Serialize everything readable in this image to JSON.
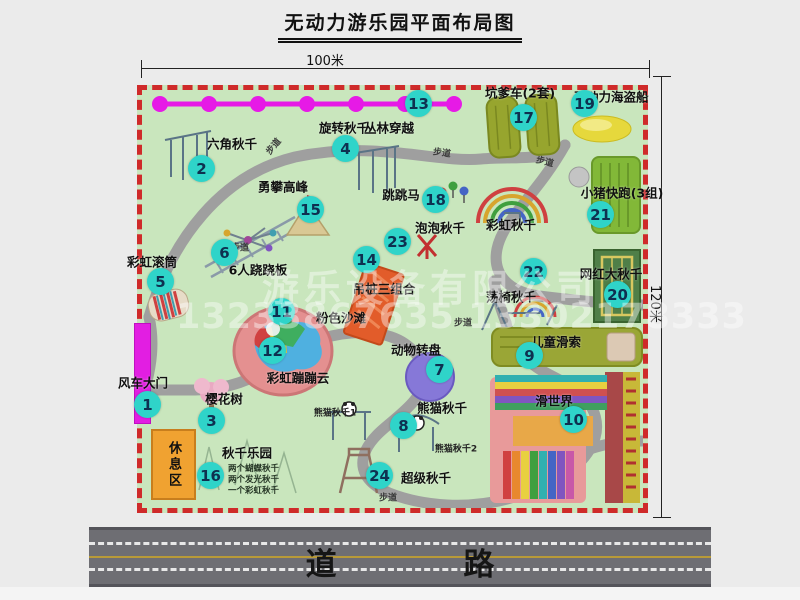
{
  "title": "无动力游乐园平面布局图",
  "dimensions": {
    "top": "100米",
    "right": "120米"
  },
  "road": {
    "label": "道  路"
  },
  "watermark": {
    "company": "游乐设备有限公司",
    "phones": "13233867635 13302178333"
  },
  "map": {
    "path_label": "步道",
    "rest_area": "休息区",
    "rainbow_swing_label": "彩虹秋千",
    "panda_sub1": "熊猫秋千1",
    "panda_sub2": "熊猫秋千2",
    "swing_park_notes": [
      "两个蝴蝶秋千",
      "两个发光秋千",
      "一个彩虹秋千"
    ]
  },
  "attractions": [
    {
      "num": "1",
      "label": "风车大门",
      "bx": 147,
      "by": 404,
      "lx": 143,
      "ly": 382
    },
    {
      "num": "2",
      "label": "六角秋千",
      "bx": 201,
      "by": 168,
      "lx": 232,
      "ly": 143
    },
    {
      "num": "3",
      "label": "樱花树",
      "bx": 211,
      "by": 420,
      "lx": 224,
      "ly": 398
    },
    {
      "num": "4",
      "label": "旋转秋千",
      "bx": 345,
      "by": 148,
      "lx": 344,
      "ly": 127
    },
    {
      "num": "5",
      "label": "彩虹滚筒",
      "bx": 160,
      "by": 281,
      "lx": 152,
      "ly": 261
    },
    {
      "num": "6",
      "label": "6人跷跷板",
      "bx": 224,
      "by": 252,
      "lx": 258,
      "ly": 269
    },
    {
      "num": "7",
      "label": "动物转盘",
      "bx": 439,
      "by": 369,
      "lx": 416,
      "ly": 349
    },
    {
      "num": "8",
      "label": "熊猫秋千",
      "bx": 403,
      "by": 425,
      "lx": 442,
      "ly": 407
    },
    {
      "num": "9",
      "label": "儿童滑索",
      "bx": 529,
      "by": 355,
      "lx": 556,
      "ly": 341
    },
    {
      "num": "10",
      "label": "滑世界",
      "bx": 573,
      "by": 419,
      "lx": 554,
      "ly": 400
    },
    {
      "num": "11",
      "label": "粉色沙滩",
      "bx": 281,
      "by": 311,
      "lx": 341,
      "ly": 317
    },
    {
      "num": "12",
      "label": "彩虹蹦蹦云",
      "bx": 272,
      "by": 350,
      "lx": 298,
      "ly": 377
    },
    {
      "num": "13",
      "label": "丛林穿越",
      "bx": 418,
      "by": 103,
      "lx": 389,
      "ly": 127
    },
    {
      "num": "14",
      "label": "吊桩三组合",
      "bx": 366,
      "by": 259,
      "lx": 384,
      "ly": 288
    },
    {
      "num": "15",
      "label": "勇攀高峰",
      "bx": 310,
      "by": 209,
      "lx": 283,
      "ly": 186
    },
    {
      "num": "16",
      "label": "秋千乐园",
      "bx": 210,
      "by": 475,
      "lx": 247,
      "ly": 452
    },
    {
      "num": "17",
      "label": "坑爹车(2套)",
      "bx": 523,
      "by": 117,
      "lx": 520,
      "ly": 92
    },
    {
      "num": "18",
      "label": "跳跳马",
      "bx": 435,
      "by": 199,
      "lx": 401,
      "ly": 194
    },
    {
      "num": "19",
      "label": "无动力海盗船",
      "bx": 584,
      "by": 103,
      "lx": 611,
      "ly": 96
    },
    {
      "num": "20",
      "label": "网红大秋千",
      "bx": 617,
      "by": 294,
      "lx": 611,
      "ly": 273
    },
    {
      "num": "21",
      "label": "小猪快跑(3组)",
      "bx": 600,
      "by": 214,
      "lx": 622,
      "ly": 192
    },
    {
      "num": "22",
      "label": "荡椅秋千",
      "bx": 533,
      "by": 271,
      "lx": 511,
      "ly": 296
    },
    {
      "num": "23",
      "label": "泡泡秋千",
      "bx": 397,
      "by": 241,
      "lx": 440,
      "ly": 227
    },
    {
      "num": "24",
      "label": "超级秋千",
      "bx": 379,
      "by": 475,
      "lx": 426,
      "ly": 477
    }
  ]
}
